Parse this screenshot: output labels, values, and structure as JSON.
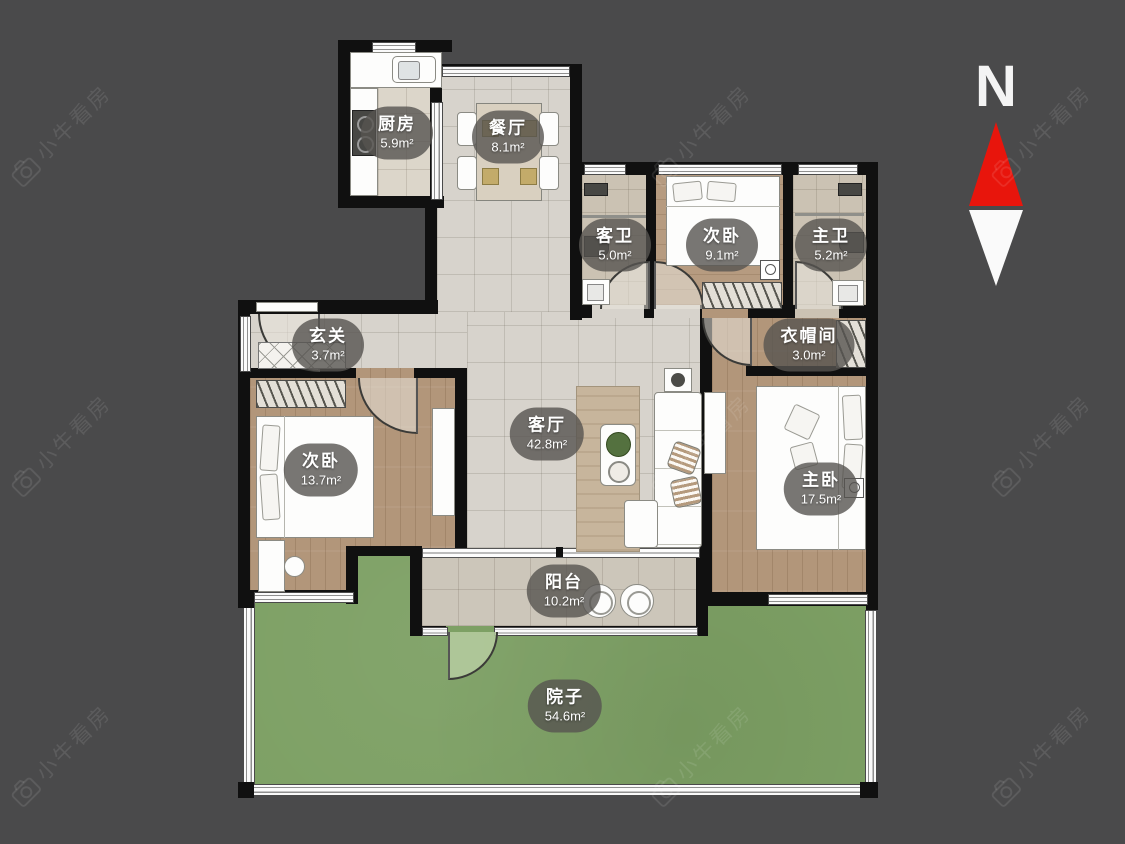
{
  "compass": {
    "label": "N"
  },
  "watermark": {
    "text": "小牛看房",
    "icon": "camera-icon"
  },
  "colors": {
    "background": "#4a4a4b",
    "wall": "#101010",
    "yard_green": "#7da064",
    "tile_floor": "#d7d3cc",
    "wood_floor": "#b2967a",
    "compass_red": "#e8150c",
    "label_bubble": "#565450",
    "watermark": "#ffffff"
  },
  "rooms": {
    "kitchen": {
      "name": "厨房",
      "area": "5.9m²"
    },
    "dining": {
      "name": "餐厅",
      "area": "8.1m²"
    },
    "guest_bath": {
      "name": "客卫",
      "area": "5.0m²"
    },
    "bedroom_top": {
      "name": "次卧",
      "area": "9.1m²"
    },
    "master_bath": {
      "name": "主卫",
      "area": "5.2m²"
    },
    "entry": {
      "name": "玄关",
      "area": "3.7m²"
    },
    "cloakroom": {
      "name": "衣帽间",
      "area": "3.0m²"
    },
    "bedroom_left": {
      "name": "次卧",
      "area": "13.7m²"
    },
    "living": {
      "name": "客厅",
      "area": "42.8m²"
    },
    "master_bedroom": {
      "name": "主卧",
      "area": "17.5m²"
    },
    "balcony": {
      "name": "阳台",
      "area": "10.2m²"
    },
    "yard": {
      "name": "院子",
      "area": "54.6m²"
    }
  }
}
